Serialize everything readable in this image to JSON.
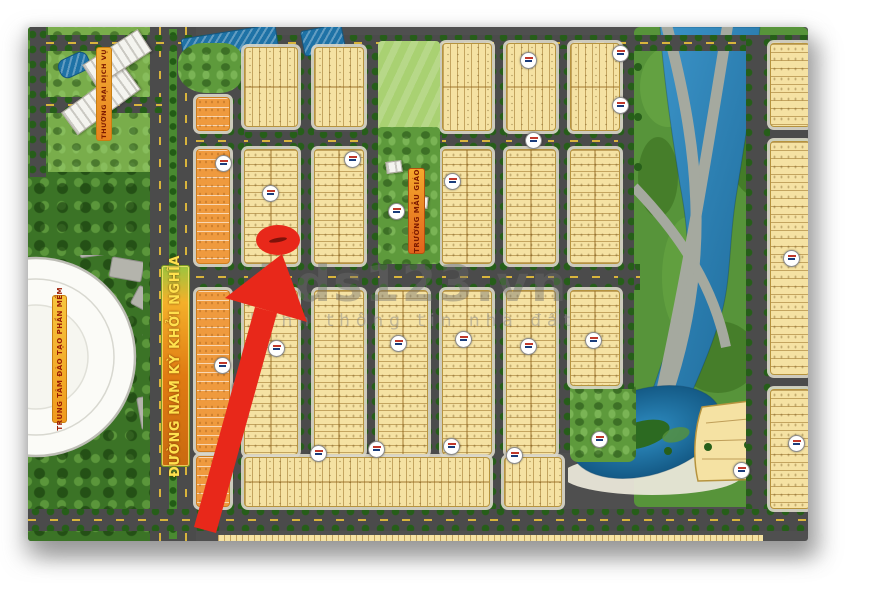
{
  "watermark": {
    "brand": "bds123.vn",
    "tagline": "kênh thông tin nhà đất"
  },
  "map_labels": {
    "main_road": "ĐƯỜNG NAM KỲ KHỞI NGHĨA",
    "commercial_area": "THƯƠNG MẠI DỊCH VỤ",
    "kindergarten": "TRƯỜNG MẪU GIÁO",
    "training_center": "TRUNG TÂM ĐÀO TẠO PHẦN MỀM"
  },
  "marker": {
    "icon": "red-arrow-marker",
    "color": "#e8281a"
  },
  "palette": {
    "lot_yellow": "#f5e2a3",
    "lot_orange": "#ef9a3e",
    "road_gray": "#4b4b4b",
    "water_blue": "#2b85bb",
    "forest_green": "#3b7326",
    "park_green": "#5e9a3c",
    "sidewalk": "#d9d6ca",
    "banner_orange": "#e8821e",
    "banner_text_yellow": "#ffe14d",
    "banner_text_red": "#9b1c04"
  }
}
